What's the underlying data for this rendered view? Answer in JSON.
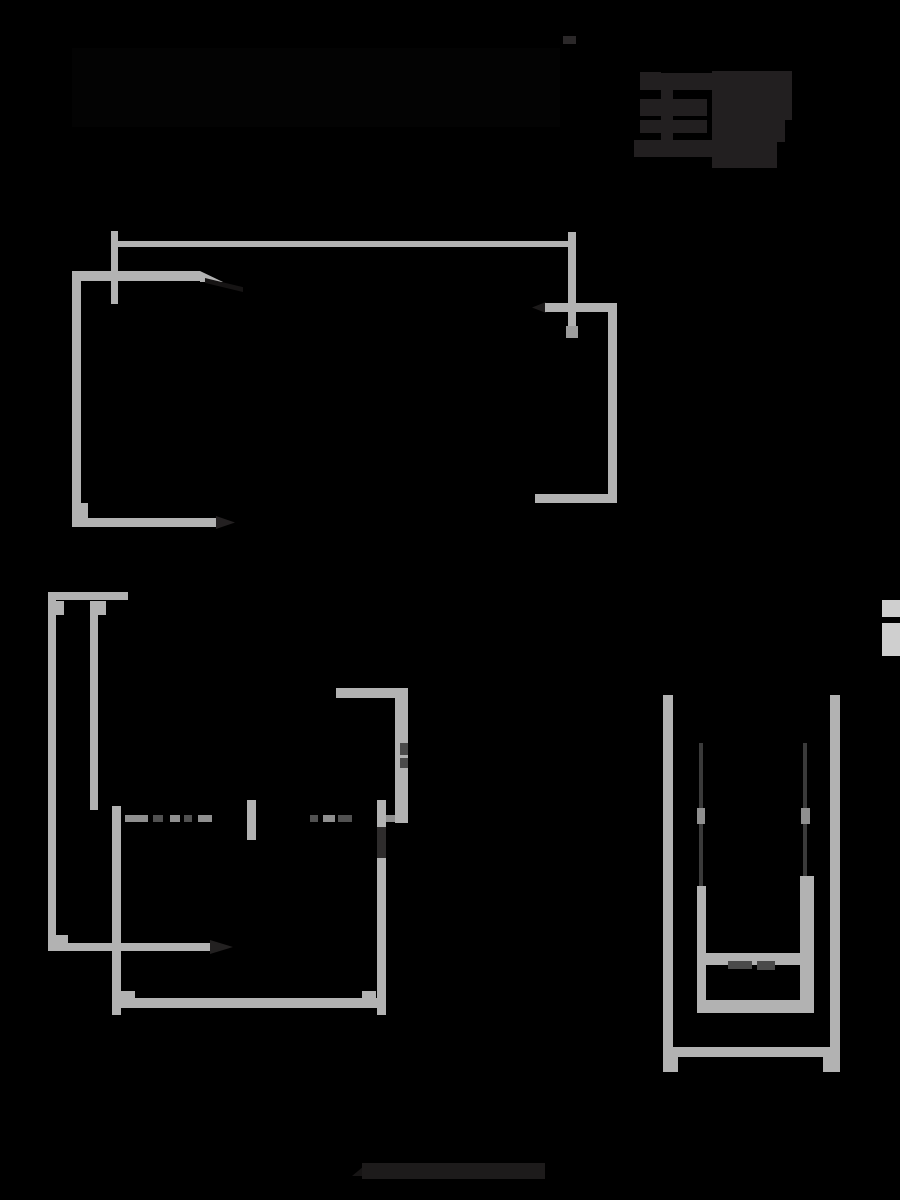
{
  "canvas": {
    "width": 900,
    "height": 1200,
    "background": "#000000"
  },
  "palette": {
    "line_gray": "#b2b2b2",
    "light_gray": "#cfcfcf",
    "mid_gray": "#8f8f8f",
    "dim_dark": "#4a4a4a",
    "glyph_dark": "#221f20",
    "hidden_black": "#030303"
  },
  "shapes": [
    {
      "name": "hidden-title-bar",
      "x": 72,
      "y": 48,
      "w": 488,
      "h": 79,
      "color": "#030303"
    },
    {
      "name": "top-center-dot",
      "x": 563,
      "y": 36,
      "w": 13,
      "h": 8,
      "color": "#2b2829"
    },
    {
      "name": "logo-tab-1",
      "x": 640,
      "y": 72,
      "w": 21,
      "h": 18,
      "color": "#221f20"
    },
    {
      "name": "logo-tab-2",
      "x": 640,
      "y": 99,
      "w": 21,
      "h": 17,
      "color": "#221f20"
    },
    {
      "name": "logo-tab-3",
      "x": 640,
      "y": 120,
      "w": 21,
      "h": 13,
      "color": "#221f20"
    },
    {
      "name": "logo-tab-4",
      "x": 634,
      "y": 140,
      "w": 27,
      "h": 17,
      "color": "#221f20"
    },
    {
      "name": "logo-spine",
      "x": 661,
      "y": 73,
      "w": 12,
      "h": 84,
      "color": "#221f20"
    },
    {
      "name": "logo-arm-1",
      "x": 673,
      "y": 73,
      "w": 41,
      "h": 17,
      "color": "#221f20"
    },
    {
      "name": "logo-arm-2",
      "x": 673,
      "y": 99,
      "w": 34,
      "h": 17,
      "color": "#221f20"
    },
    {
      "name": "logo-arm-3",
      "x": 673,
      "y": 120,
      "w": 34,
      "h": 13,
      "color": "#221f20"
    },
    {
      "name": "logo-arm-4",
      "x": 673,
      "y": 140,
      "w": 41,
      "h": 17,
      "color": "#221f20"
    },
    {
      "name": "logo-blob-top",
      "x": 712,
      "y": 71,
      "w": 80,
      "h": 49,
      "color": "#221f20"
    },
    {
      "name": "logo-blob-mid",
      "x": 712,
      "y": 120,
      "w": 73,
      "h": 22,
      "color": "#221f20"
    },
    {
      "name": "logo-blob-bottom",
      "x": 712,
      "y": 142,
      "w": 65,
      "h": 26,
      "color": "#221f20"
    },
    {
      "name": "upper-dim-line",
      "x": 114,
      "y": 241,
      "w": 458,
      "h": 6,
      "color": "#b2b2b2"
    },
    {
      "name": "upper-dim-tick-left",
      "x": 111,
      "y": 231,
      "w": 7,
      "h": 73,
      "color": "#b2b2b2"
    },
    {
      "name": "upper-dim-tick-right",
      "x": 568,
      "y": 232,
      "w": 8,
      "h": 105,
      "color": "#b2b2b2"
    },
    {
      "name": "upper-dim-arrow-nub",
      "x": 566,
      "y": 326,
      "w": 12,
      "h": 12,
      "color": "#9c9c9c"
    },
    {
      "name": "upper-top-edge",
      "x": 73,
      "y": 271,
      "w": 127,
      "h": 10,
      "color": "#b2b2b2"
    },
    {
      "name": "upper-top-edge-taper",
      "x": 200,
      "y": 271,
      "w": 23,
      "h": 11,
      "color": "#b2b2b2",
      "clip": "polygon(0 0, 100% 100%, 0 100%)"
    },
    {
      "name": "upper-roof-diagonal",
      "x": 205,
      "y": 278,
      "w": 38,
      "h": 14,
      "color": "#161414",
      "clip": "polygon(0 0, 100% 65%, 100% 100%, 0 35%)"
    },
    {
      "name": "upper-left-edge",
      "x": 72,
      "y": 271,
      "w": 9,
      "h": 256,
      "color": "#b2b2b2"
    },
    {
      "name": "upper-corner-block",
      "x": 72,
      "y": 503,
      "w": 16,
      "h": 24,
      "color": "#b2b2b2"
    },
    {
      "name": "upper-bottom-edge",
      "x": 72,
      "y": 518,
      "w": 144,
      "h": 9,
      "color": "#b2b2b2"
    },
    {
      "name": "upper-bottom-arrow",
      "x": 216,
      "y": 516,
      "w": 19,
      "h": 13,
      "color": "#232021",
      "clip": "polygon(0 0, 100% 50%, 0 100%)"
    },
    {
      "name": "upper-bracket-arrow",
      "x": 532,
      "y": 302,
      "w": 14,
      "h": 11,
      "color": "#1c1a1a",
      "clip": "polygon(100% 0, 0 50%, 100% 100%)"
    },
    {
      "name": "upper-bracket-top",
      "x": 545,
      "y": 303,
      "w": 72,
      "h": 9,
      "color": "#b2b2b2"
    },
    {
      "name": "upper-bracket-right",
      "x": 608,
      "y": 303,
      "w": 9,
      "h": 200,
      "color": "#b2b2b2"
    },
    {
      "name": "upper-bracket-bottom",
      "x": 535,
      "y": 494,
      "w": 82,
      "h": 9,
      "color": "#b2b2b2"
    },
    {
      "name": "rear-top-rail",
      "x": 48,
      "y": 592,
      "w": 80,
      "h": 8,
      "color": "#b2b2b2"
    },
    {
      "name": "rear-outer-left-wall",
      "x": 48,
      "y": 592,
      "w": 8,
      "h": 359,
      "color": "#b2b2b2"
    },
    {
      "name": "rear-outer-wall-tab",
      "x": 56,
      "y": 601,
      "w": 8,
      "h": 14,
      "color": "#b2b2b2"
    },
    {
      "name": "rear-inner-left-wall",
      "x": 90,
      "y": 601,
      "w": 8,
      "h": 209,
      "color": "#b2b2b2"
    },
    {
      "name": "rear-inner-wall-tab",
      "x": 98,
      "y": 601,
      "w": 8,
      "h": 14,
      "color": "#b2b2b2"
    },
    {
      "name": "rear-step-block",
      "x": 56,
      "y": 935,
      "w": 12,
      "h": 16,
      "color": "#b2b2b2"
    },
    {
      "name": "rear-width-arrow-line",
      "x": 48,
      "y": 943,
      "w": 162,
      "h": 8,
      "color": "#b2b2b2"
    },
    {
      "name": "rear-width-arrow-head",
      "x": 210,
      "y": 940,
      "w": 23,
      "h": 14,
      "color": "#232121",
      "clip": "polygon(0 0, 100% 50%, 0 100%)"
    },
    {
      "name": "rear-inner-left-lower",
      "x": 112,
      "y": 806,
      "w": 9,
      "h": 209,
      "color": "#b2b2b2"
    },
    {
      "name": "rear-bottom-rail",
      "x": 120,
      "y": 998,
      "w": 262,
      "h": 10,
      "color": "#b2b2b2"
    },
    {
      "name": "rear-bottom-tab-left",
      "x": 120,
      "y": 991,
      "w": 15,
      "h": 8,
      "color": "#b2b2b2"
    },
    {
      "name": "rear-bottom-tab-right",
      "x": 362,
      "y": 991,
      "w": 14,
      "h": 8,
      "color": "#b2b2b2"
    },
    {
      "name": "rear-corner-top-rail",
      "x": 336,
      "y": 688,
      "w": 72,
      "h": 10,
      "color": "#b2b2b2"
    },
    {
      "name": "rear-corner-right-wall",
      "x": 395,
      "y": 688,
      "w": 13,
      "h": 135,
      "color": "#b2b2b2"
    },
    {
      "name": "rear-corner-nub-1",
      "x": 400,
      "y": 743,
      "w": 8,
      "h": 12,
      "color": "#4a4a4a"
    },
    {
      "name": "rear-corner-nub-2",
      "x": 400,
      "y": 758,
      "w": 8,
      "h": 10,
      "color": "#4a4a4a"
    },
    {
      "name": "rear-right-vertical",
      "x": 377,
      "y": 800,
      "w": 9,
      "h": 215,
      "color": "#b2b2b2"
    },
    {
      "name": "rear-right-arrow-zone",
      "x": 377,
      "y": 827,
      "w": 9,
      "h": 31,
      "color": "#2e2c2c"
    },
    {
      "name": "rear-center-tick",
      "x": 247,
      "y": 800,
      "w": 9,
      "h": 40,
      "color": "#b2b2b2"
    },
    {
      "name": "rear-dash-1",
      "x": 125,
      "y": 815,
      "w": 23,
      "h": 7,
      "color": "#8f8f8f"
    },
    {
      "name": "rear-dash-2",
      "x": 153,
      "y": 815,
      "w": 10,
      "h": 7,
      "color": "#515151"
    },
    {
      "name": "rear-dash-3",
      "x": 170,
      "y": 815,
      "w": 10,
      "h": 7,
      "color": "#8f8f8f"
    },
    {
      "name": "rear-dash-4",
      "x": 184,
      "y": 815,
      "w": 8,
      "h": 7,
      "color": "#515151"
    },
    {
      "name": "rear-dash-5",
      "x": 198,
      "y": 815,
      "w": 14,
      "h": 7,
      "color": "#8f8f8f"
    },
    {
      "name": "rear-dash-6",
      "x": 310,
      "y": 815,
      "w": 8,
      "h": 7,
      "color": "#515151"
    },
    {
      "name": "rear-dash-7",
      "x": 323,
      "y": 815,
      "w": 12,
      "h": 7,
      "color": "#8f8f8f"
    },
    {
      "name": "rear-dash-8",
      "x": 338,
      "y": 815,
      "w": 14,
      "h": 7,
      "color": "#515151"
    },
    {
      "name": "rear-dash-9",
      "x": 386,
      "y": 815,
      "w": 9,
      "h": 7,
      "color": "#8f8f8f"
    },
    {
      "name": "rail-outer-left",
      "x": 663,
      "y": 695,
      "w": 10,
      "h": 362,
      "color": "#b2b2b2"
    },
    {
      "name": "rail-outer-right",
      "x": 830,
      "y": 695,
      "w": 10,
      "h": 362,
      "color": "#b2b2b2"
    },
    {
      "name": "rail-bottom-bar",
      "x": 663,
      "y": 1047,
      "w": 177,
      "h": 10,
      "color": "#b2b2b2"
    },
    {
      "name": "rail-foot-left",
      "x": 663,
      "y": 1057,
      "w": 15,
      "h": 15,
      "color": "#b2b2b2"
    },
    {
      "name": "rail-foot-right",
      "x": 823,
      "y": 1057,
      "w": 17,
      "h": 15,
      "color": "#b2b2b2"
    },
    {
      "name": "rail-inner-left-thin",
      "x": 699,
      "y": 743,
      "w": 4,
      "h": 145,
      "color": "#3a3a3a"
    },
    {
      "name": "rail-inner-right-thin",
      "x": 803,
      "y": 743,
      "w": 4,
      "h": 135,
      "color": "#3a3a3a"
    },
    {
      "name": "rail-inner-left-dash",
      "x": 697,
      "y": 808,
      "w": 8,
      "h": 16,
      "color": "#8f8f8f"
    },
    {
      "name": "rail-inner-right-dash",
      "x": 801,
      "y": 808,
      "w": 9,
      "h": 16,
      "color": "#8f8f8f"
    },
    {
      "name": "rail-inner-left-wall",
      "x": 697,
      "y": 886,
      "w": 9,
      "h": 127,
      "color": "#b2b2b2"
    },
    {
      "name": "rail-inner-right-wall",
      "x": 800,
      "y": 876,
      "w": 14,
      "h": 137,
      "color": "#b2b2b2"
    },
    {
      "name": "rail-inner-bar-upper",
      "x": 697,
      "y": 953,
      "w": 117,
      "h": 12,
      "color": "#b2b2b2"
    },
    {
      "name": "rail-inner-bar-lower",
      "x": 697,
      "y": 1000,
      "w": 117,
      "h": 13,
      "color": "#b2b2b2"
    },
    {
      "name": "rail-inner-tab-1",
      "x": 728,
      "y": 961,
      "w": 24,
      "h": 8,
      "color": "#4a4a4a"
    },
    {
      "name": "rail-inner-tab-2",
      "x": 757,
      "y": 961,
      "w": 18,
      "h": 9,
      "color": "#4a4a4a"
    },
    {
      "name": "edge-mark-upper",
      "x": 882,
      "y": 600,
      "w": 18,
      "h": 17,
      "color": "#cfcfcf"
    },
    {
      "name": "edge-mark-lower",
      "x": 882,
      "y": 623,
      "w": 18,
      "h": 33,
      "color": "#cfcfcf"
    },
    {
      "name": "footer-smudge-tip",
      "x": 352,
      "y": 1166,
      "w": 12,
      "h": 10,
      "color": "#171515",
      "clip": "polygon(100% 0, 100% 100%, 0 100%)"
    },
    {
      "name": "footer-smudge",
      "x": 362,
      "y": 1163,
      "w": 183,
      "h": 16,
      "color": "#1d1b1b"
    }
  ]
}
